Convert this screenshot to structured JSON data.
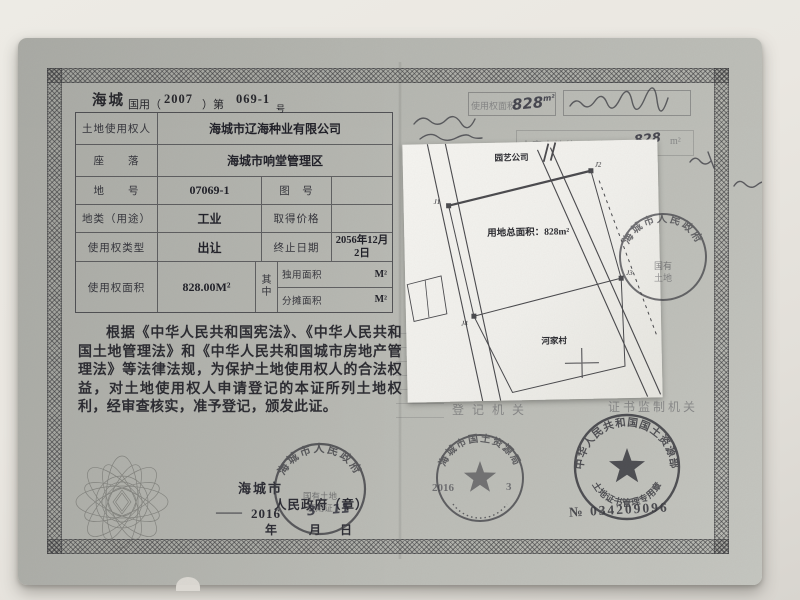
{
  "header": {
    "region": "海城",
    "form_open": "国用（",
    "year": "2007",
    "form_mid": "）第",
    "number": "069-1",
    "suffix": "号"
  },
  "table": {
    "r1_label": "土地使用权人",
    "r1_value": "海城市辽海种业有限公司",
    "r2_label": "座　　落",
    "r2_value": "海城市响堂管理区",
    "r3_label": "地　　号",
    "r3_value": "07069-1",
    "r3_label2": "图　号",
    "r3_value2": "",
    "r4_label": "地类（用途）",
    "r4_value": "工业",
    "r4_label2": "取得价格",
    "r4_value2": "",
    "r5_label": "使用权类型",
    "r5_value": "出让",
    "r5_label2": "终止日期",
    "r5_value2": "2056年12月2日",
    "r6_label": "使用权面积",
    "r6_value": "828.00M²",
    "r6_mid": "其中",
    "r6_sub1_label": "独用面积",
    "r6_sub1_unit": "M²",
    "r6_sub2_label": "分摊面积",
    "r6_sub2_unit": "M²"
  },
  "statement": "根据《中华人民共和国宪法》、《中华人民共和国土地管理法》和《中华人民共和国城市房地产管理法》等法律法规，为保护土地使用权人的合法权益，对土地使用权人申请登记的本证所列土地权利，经审查核实，准予登记，颁发此证。",
  "issuer": {
    "name": "海城市",
    "title": "人民政府（章）",
    "dash": "——",
    "year": "2016",
    "month": "3",
    "day": "11",
    "year_label": "年",
    "month_label": "月",
    "day_label": "日"
  },
  "map": {
    "company": "园艺公司",
    "village": "河家村",
    "area": "用地总面积：828m²",
    "j1": "J1",
    "j2": "J2",
    "j3": "J3",
    "j4": "J4"
  },
  "right_page": {
    "box_label": "使用权面积",
    "box_value": "828",
    "box_unit": "m²",
    "area_line_label": "本宗土地使用面积",
    "area_line_value": "828",
    "area_line_unit": "m²",
    "registration_label": "登记机关",
    "supervision_label": "证书监制机关",
    "reg_year": "2016",
    "reg_month": "3"
  },
  "seals": {
    "gov_arc": "海城市人民政府",
    "gov_inner1": "国有土地",
    "gov_inner2": "使用证",
    "bureau_arc": "海城市国土资源局",
    "ministry_arc": "中华人民共和国国土资源部",
    "ministry_bottom": "土地证书管理专用章",
    "no_label": "№",
    "no_value": "034209096",
    "map_arc": "海城市人民政府",
    "map_inner1": "国有",
    "map_inner2": "土地"
  }
}
